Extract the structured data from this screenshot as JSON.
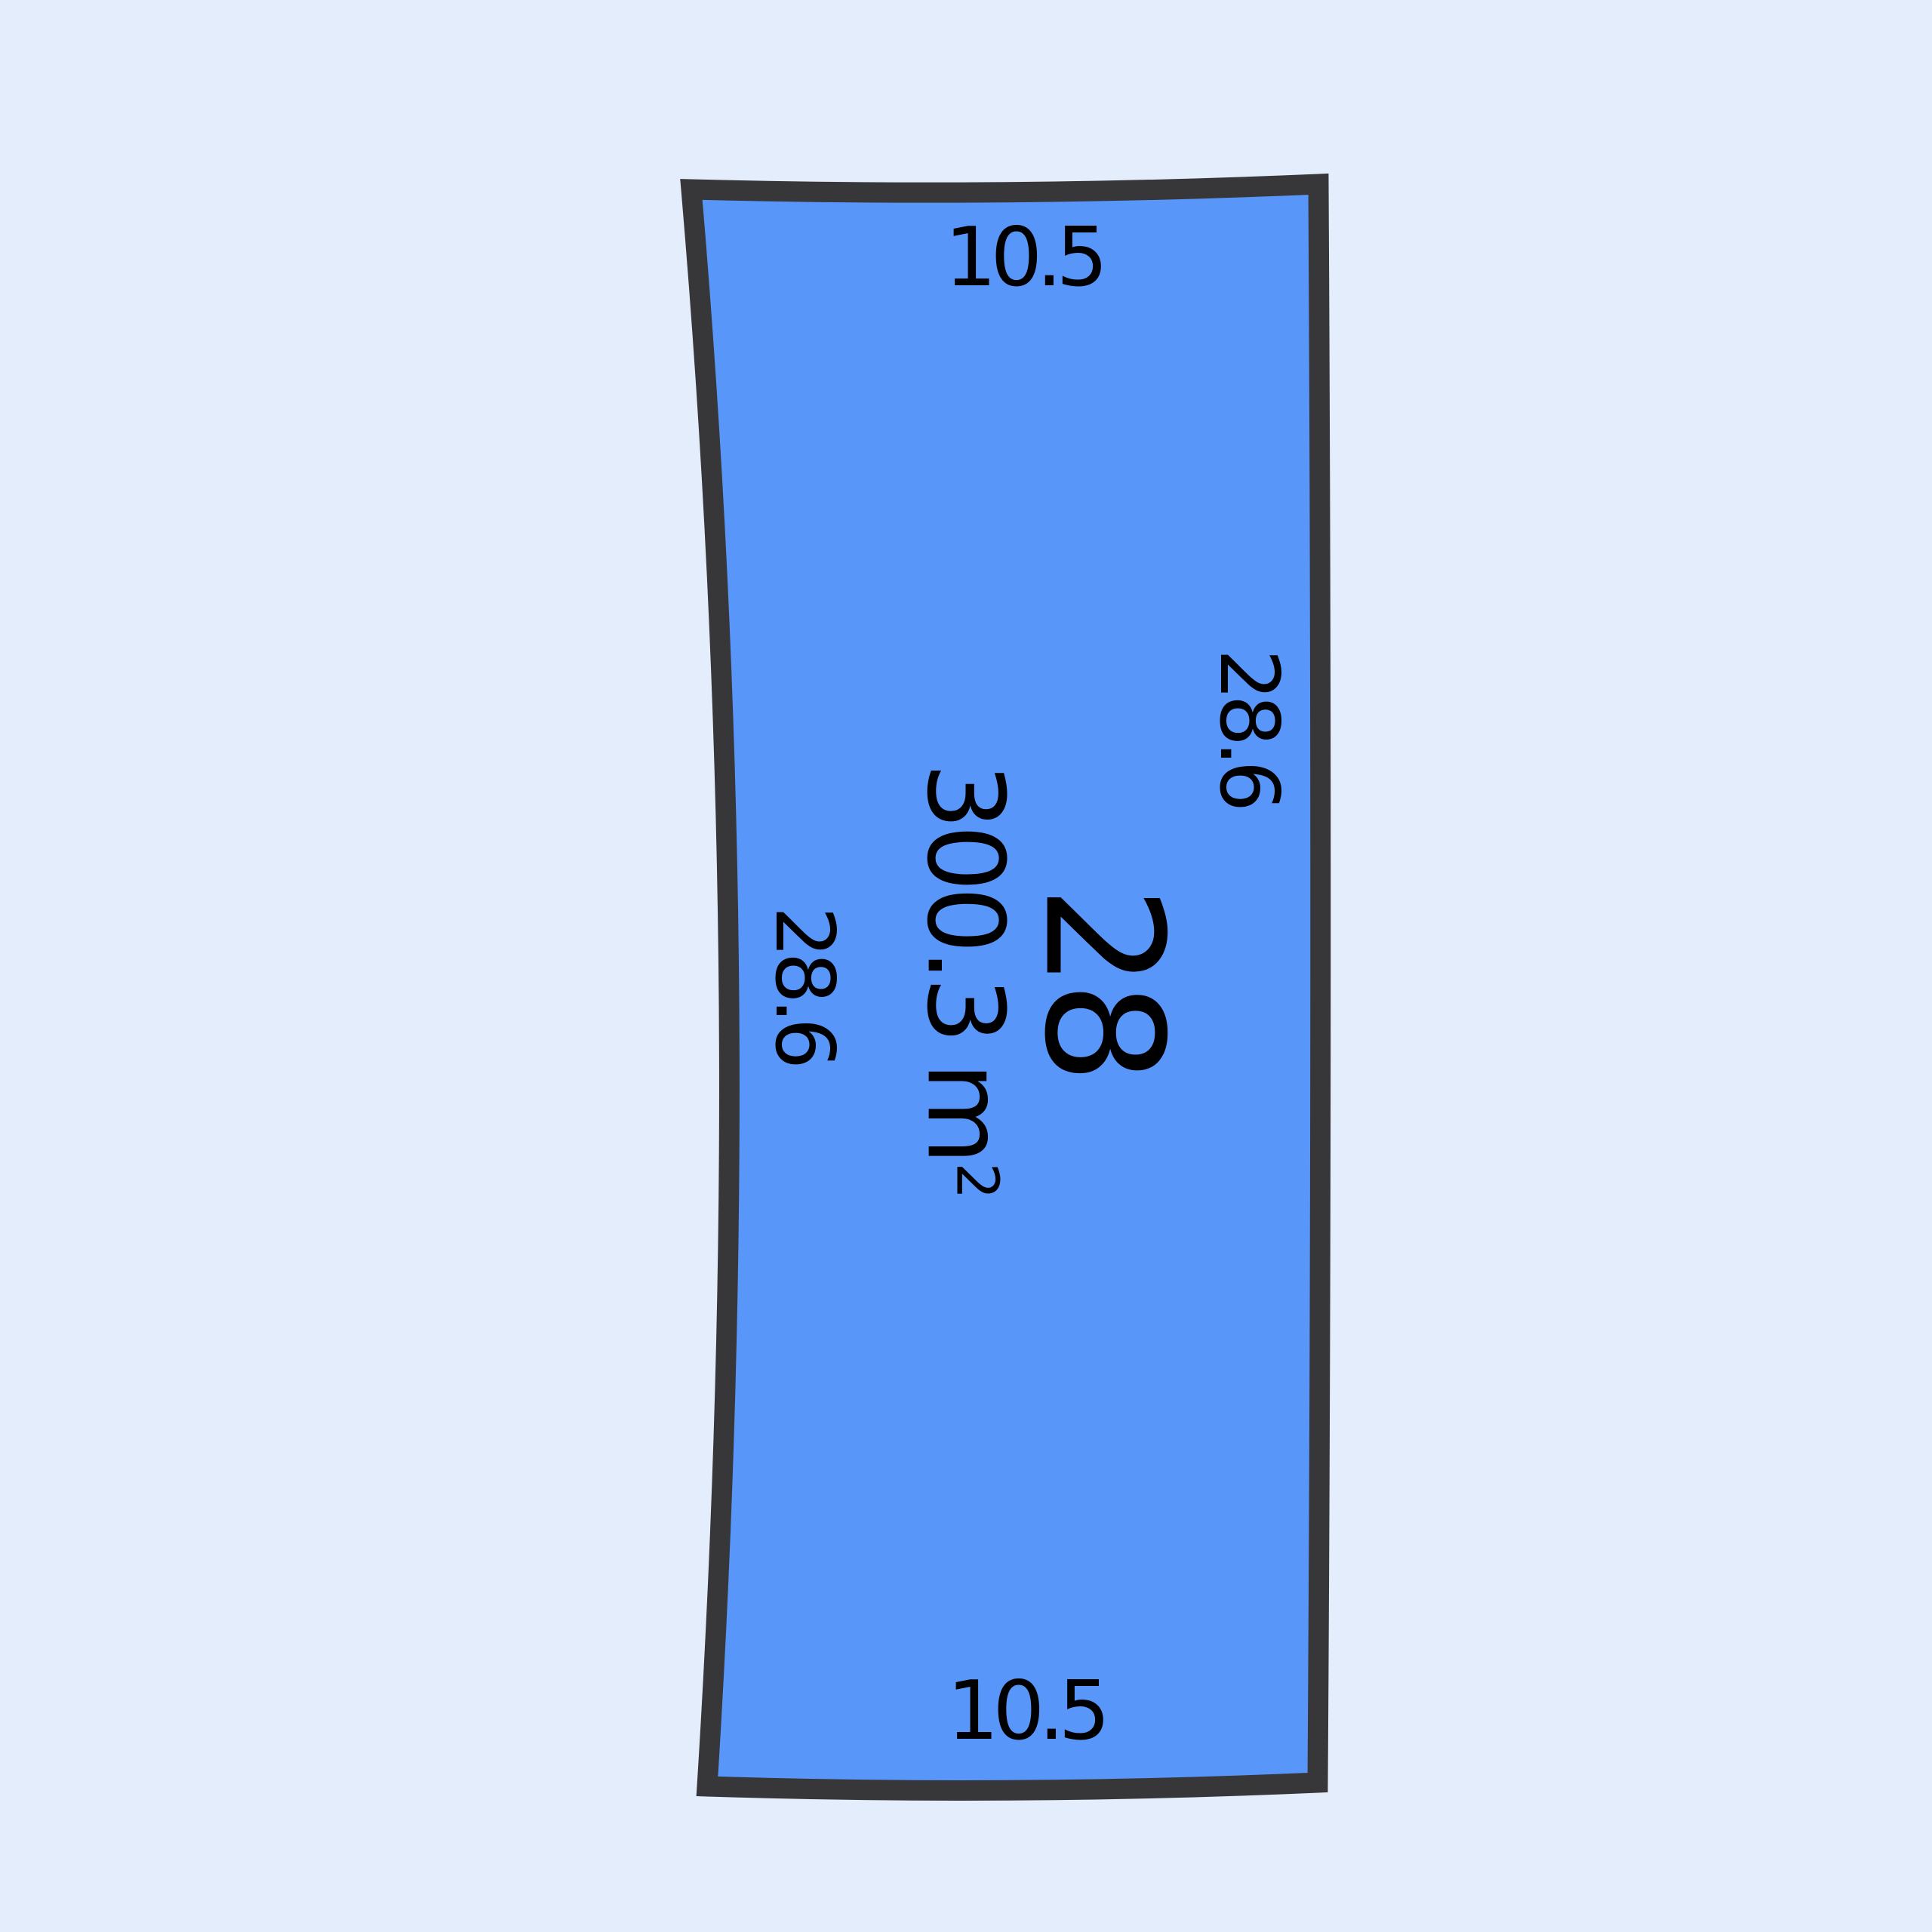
{
  "canvas": {
    "background_color": "#E4EDFB"
  },
  "lot": {
    "number": "28",
    "area_value": "300.3",
    "area_unit_base": "m",
    "area_unit_exponent": "2",
    "area_label": "300.3 m²",
    "fill_color": "#5996F9",
    "border_color": "#373739",
    "label_color": "#000000",
    "dimensions": {
      "top": "10.5",
      "bottom": "10.5",
      "left": "28.6",
      "right": "28.6"
    }
  }
}
